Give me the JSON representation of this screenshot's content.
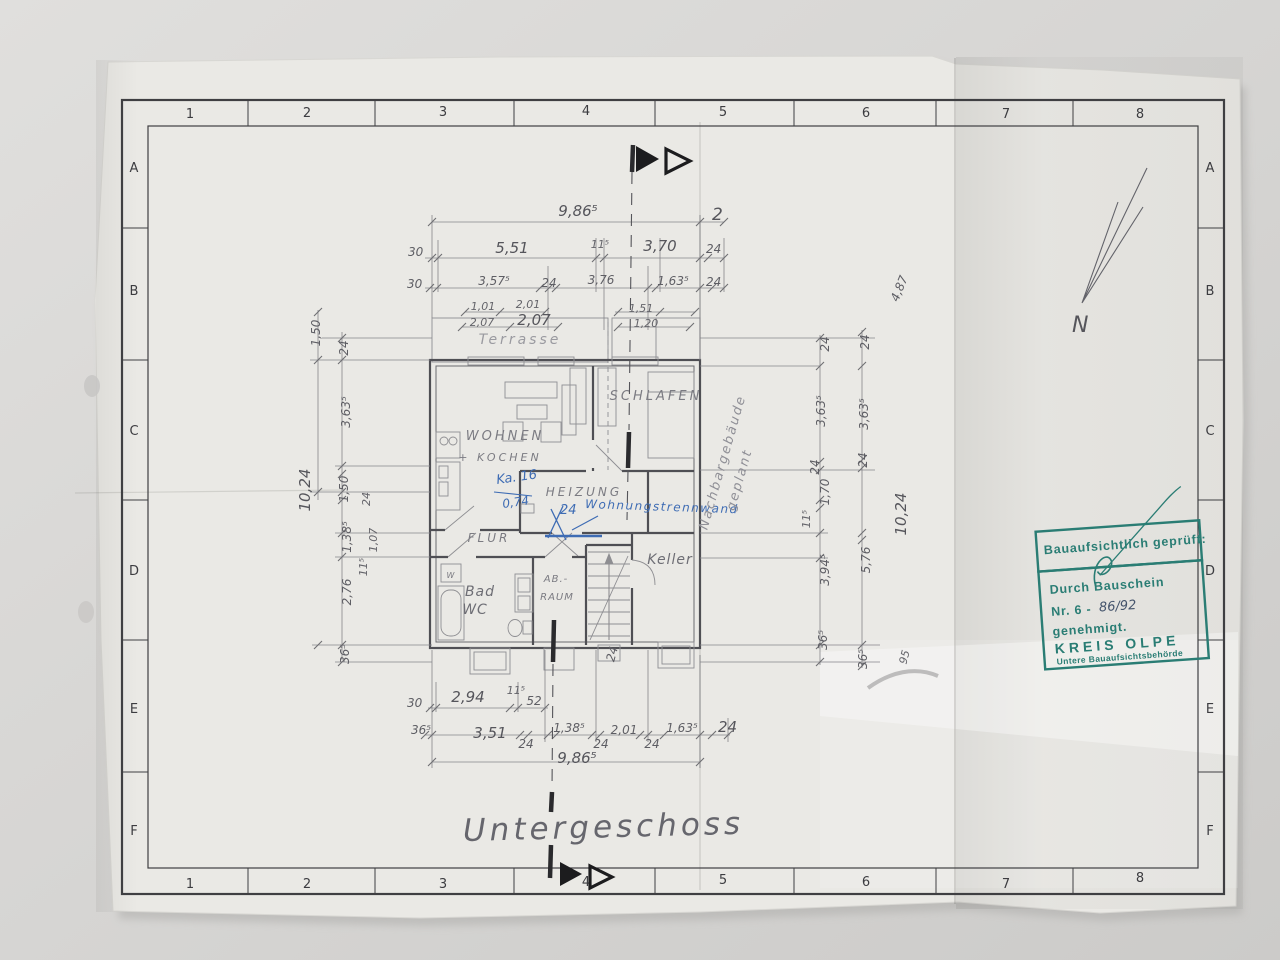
{
  "title": "Untergeschoss",
  "frame": {
    "cols": [
      "1",
      "2",
      "3",
      "4",
      "5",
      "6",
      "7",
      "8"
    ],
    "rows": [
      "A",
      "B",
      "C",
      "D",
      "E",
      "F"
    ]
  },
  "rooms": {
    "terrasse": "Terrasse",
    "wohnen": "WOHNEN",
    "kochen": "+ KOCHEN",
    "schlafen": "SCHLAFEN",
    "heizung": "HEIZUNG",
    "flur": "FLUR",
    "bad": "Bad",
    "wc": "WC",
    "abraum_1": "AB.-",
    "abraum_2": "RAUM",
    "keller": "Keller",
    "washbasin": "W"
  },
  "dims": {
    "top": [
      "9,86⁵",
      "2",
      "30",
      "5,51",
      "11⁵",
      "3,70",
      "24",
      "30",
      "3,57⁵",
      "24",
      "3,76",
      "1,63⁵",
      "24",
      "1,01",
      "2,01",
      "1,51",
      "2,07",
      "2,07",
      "1,20"
    ],
    "left": [
      "1,50",
      "24",
      "3,63⁵",
      "1,50",
      "24",
      "10,24",
      "1,38⁵",
      "1,07",
      "11⁵",
      "2,76",
      "36⁵"
    ],
    "right": [
      "24",
      "24",
      "3,63⁵",
      "3,63⁵",
      "24",
      "24",
      "1,70",
      "11⁵",
      "3,94⁵",
      "5,76",
      "36⁵",
      "36⁵",
      "4,87",
      "10,24",
      "95"
    ],
    "bottom": [
      "30",
      "2,94",
      "11⁵",
      "52",
      "36⁵",
      "3,51",
      "24",
      "1,38⁵",
      "24",
      "2,01",
      "24",
      "1,63⁵",
      "24",
      "9,86⁵"
    ],
    "inner": [
      "24"
    ]
  },
  "annotations": {
    "ka": "Ka. 16",
    "ka_value": "0,74",
    "wall_thickness": "24",
    "wall_note": "Wohnungstrennwand",
    "neighbor_line1": "Nachbargebäude",
    "neighbor_line2": "geplant"
  },
  "north": {
    "label": "N"
  },
  "stamp": {
    "line1": "Bauaufsichtlich geprüft:",
    "line2": "Durch Bauschein",
    "line3": "Nr. 6 -",
    "line3_hand": "86/92",
    "line4": "genehmigt.",
    "line5": "KREIS OLPE",
    "line6": "Untere Bauaufsichtsbehörde"
  },
  "colors": {
    "stamp_teal": "#2a7d74",
    "pen_blue": "#3e6cb4",
    "pencil_gray": "#5e5e64",
    "paper": "#eae9e5"
  }
}
